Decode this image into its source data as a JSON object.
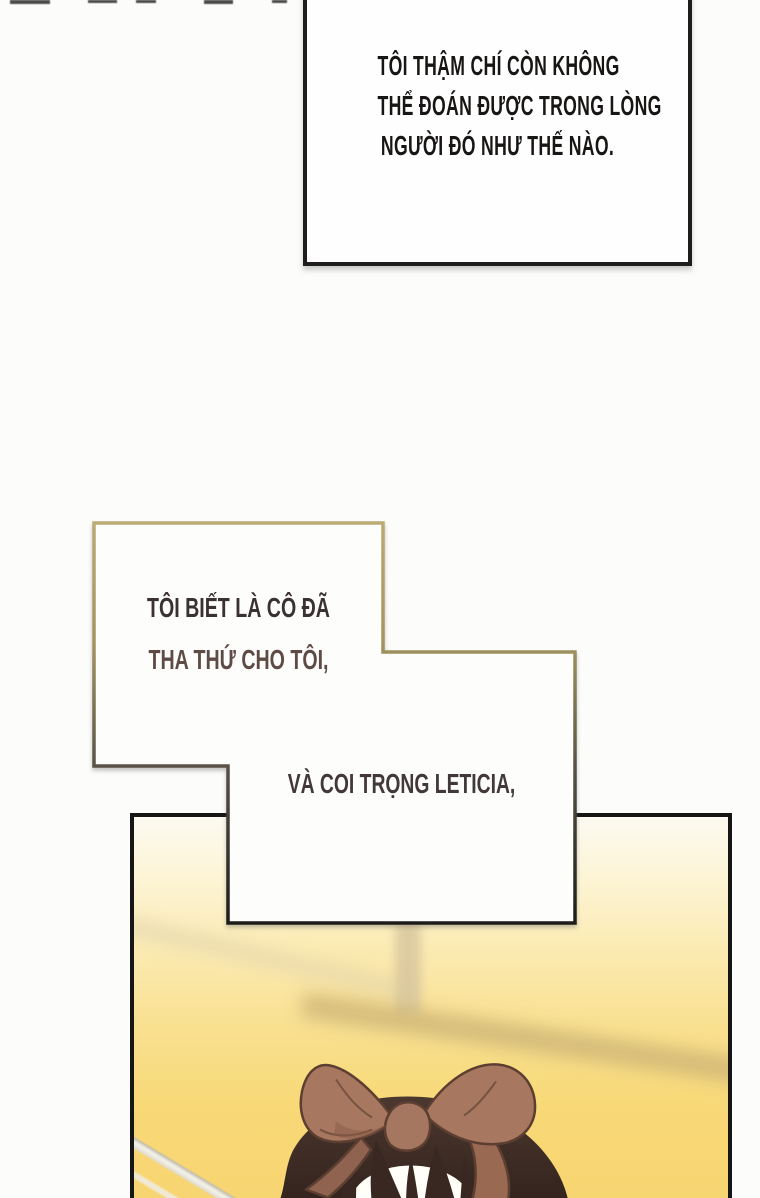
{
  "page": {
    "background": "#fcfcfb",
    "type_note": "webtoon comic page"
  },
  "speech_top": {
    "lines": [
      "TÔI THẬM CHÍ CÒN KHÔNG",
      "THỂ ĐOÁN ĐƯỢC TRONG LÒNG",
      "NGƯỜI ĐÓ NHƯ THẾ NÀO."
    ],
    "text_color": "#181614",
    "border_color": "#1e1d1b",
    "background": "#fefefe"
  },
  "speech_middle": {
    "line1": "TÔI BIẾT LÀ CÔ ĐÃ",
    "line2": "THA THỨ CHO TÔI,",
    "line3": "VÀ COI TRỌNG LETICIA,",
    "line1_color": "#3a3133",
    "line2_color": "#5e4b45",
    "line3_color": "#42383a",
    "border_gradient_top": "#b9ab72",
    "border_gradient_bottom": "#1d1c1a",
    "background": "#fdfdfc"
  },
  "artwork_panel": {
    "border_color": "#161616",
    "background_top": "#fcfaf1",
    "background_bottom": "#f7d470",
    "hair_color": "#3f2d26",
    "bow_color": "#a7775f",
    "bow_outline_color": "#5c3f31",
    "description": "blurred warm-yellow scene; light railing lower-left, blurred pole, girl with dark brown hair and large brown ribbon bow seen from above"
  }
}
